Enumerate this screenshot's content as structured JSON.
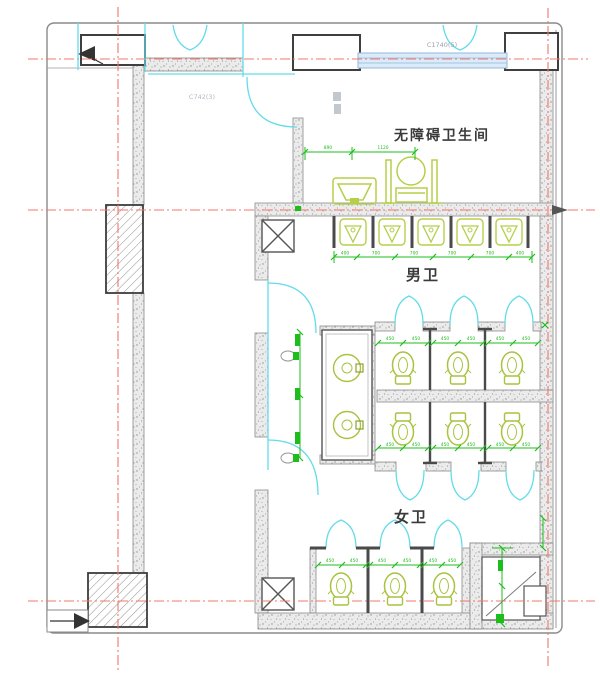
{
  "drawing": {
    "type": "floor-plan",
    "labels": {
      "accessible_room": "无障碍卫生间",
      "mens_room": "男卫",
      "womens_room": "女卫",
      "window_tag_top": "C1740(5)",
      "window_tag_left": "C742(3)"
    },
    "dimensions": {
      "accessible": [
        "890",
        "1120"
      ],
      "urinal_row": [
        "400",
        "700",
        "700",
        "700",
        "700",
        "400"
      ],
      "stall": [
        "450",
        "450"
      ]
    },
    "fixtures": {
      "urinals": 5,
      "mens_stall_toilets": 3,
      "womens_stall_toilets": 6,
      "counter_basins": 2,
      "accessible_toilet": 1,
      "accessible_sink": 1
    },
    "colors": {
      "wall_fill": "#ebebeb",
      "wall_edge": "#8a8a8a",
      "dark_frame": "#3f3f3f",
      "centerline_red": "#f4756b",
      "door_cyan": "#63dcea",
      "fixture_green": "#a9c23f",
      "dimension_green": "#1ebd1e",
      "window_fill": "#ddeaf7",
      "window_edge": "#90b8dc"
    }
  }
}
